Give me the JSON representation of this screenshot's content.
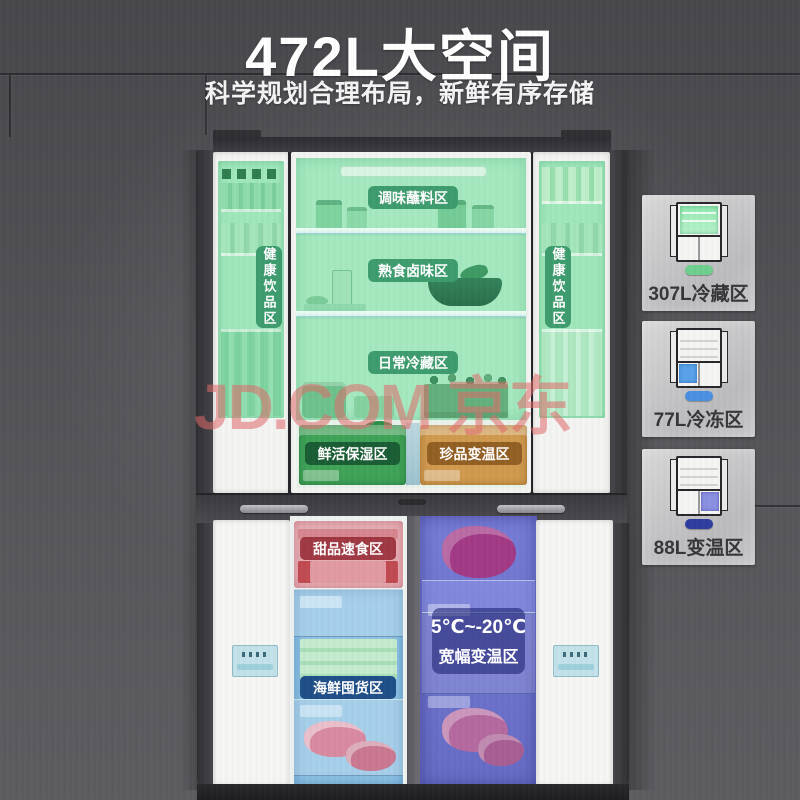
{
  "header": {
    "title": "472L大空间",
    "subtitle": "科学规划合理布局，新鲜有序存储"
  },
  "watermark": {
    "text": "JD.COM 京东",
    "color": "#E06A6A"
  },
  "fridge": {
    "upper": {
      "left_door_label": "健康饮品区",
      "right_door_label": "健康饮品区",
      "zones": [
        "调味蘸料区",
        "熟食卤味区",
        "日常冷藏区"
      ],
      "drawers": [
        {
          "label": "鲜活保湿区"
        },
        {
          "label": "珍品变温区"
        }
      ]
    },
    "lower": {
      "dessert_label": "甜品速食区",
      "seafood_label": "海鲜囤货区",
      "temp_range": "5℃~-20℃",
      "temp_zone_label": "宽幅变温区"
    }
  },
  "sidebar": {
    "cards": [
      {
        "label": "307L冷藏区",
        "pill_color": "#6FCF8F",
        "highlight": "top-fridge-section"
      },
      {
        "label": "77L冷冻区",
        "pill_color": "#4A90E2",
        "highlight": "bottom-left-section"
      },
      {
        "label": "88L变温区",
        "pill_color": "#2F3DA0",
        "highlight": "bottom-right-section"
      }
    ]
  },
  "colors": {
    "cavity_green": "#A5E9C0",
    "door_green": "#9FE7BB",
    "zone_pill_green": "#3D9C6E",
    "humid_drawer_green": "#3FA357",
    "variable_drawer_orange": "#D09A4E",
    "dessert_pink": "#E7AEB4",
    "dessert_pill_red": "#A02F3A",
    "seafood_blue": "#8EC2E4",
    "seafood_pill_blue": "#1E4F87",
    "variable_column_indigo": "#7277D2",
    "temp_panel_navy": "#1C2070"
  }
}
